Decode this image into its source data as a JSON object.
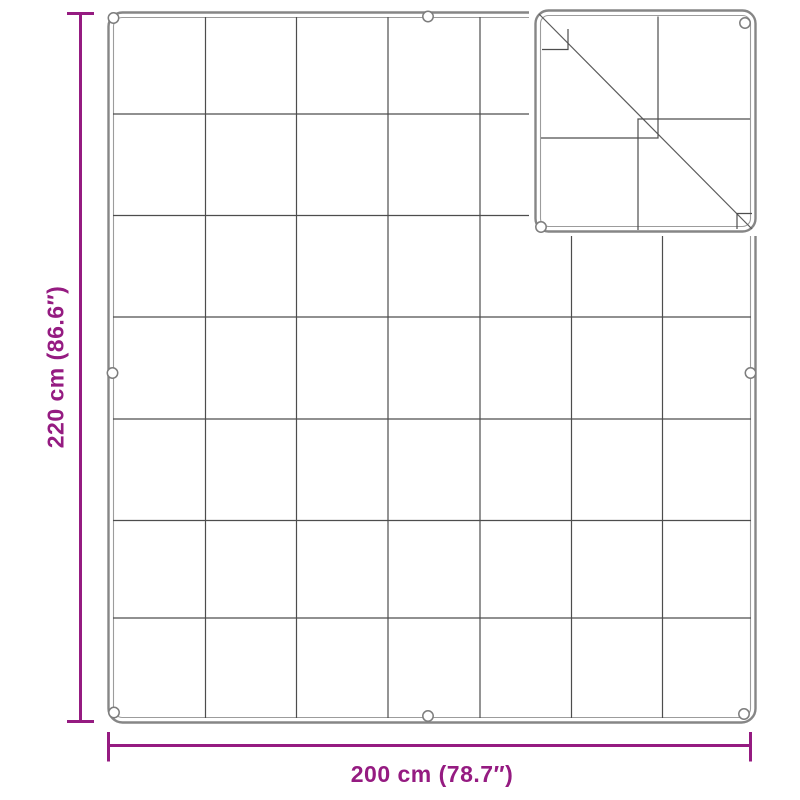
{
  "diagram": {
    "type": "product-dimension-diagram",
    "subject": "quilted tarp with corner grommets, top-right corner folded over",
    "height_label": "220 cm (86.6″)",
    "width_label": "200 cm (78.7″)",
    "grid": {
      "rows": 7,
      "columns": 7
    },
    "grommet_count": 9,
    "fold_position": "top-right-corner",
    "colors": {
      "accent": "#951B81",
      "grid_line": "#4D4D4D",
      "hem_outline": "#868686",
      "hem_inner": "#9C9C9C",
      "background": "#FFFFFF"
    }
  }
}
